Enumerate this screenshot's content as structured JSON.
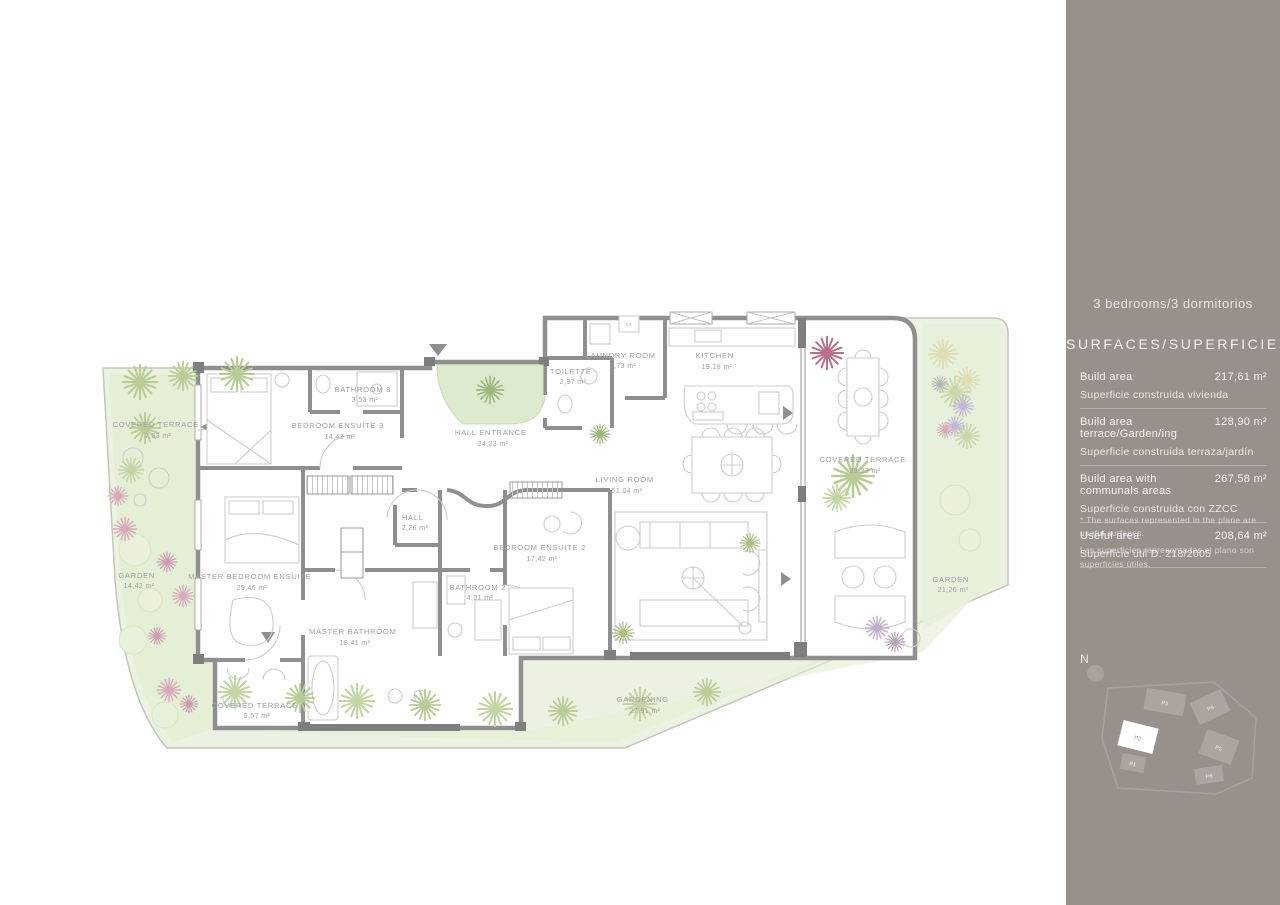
{
  "sidebar": {
    "bg_color": "#98908b",
    "title": "3 bedrooms/3 dormitorios",
    "subtitle": "SURFACES/SUPERFICIES",
    "rows": [
      {
        "en": "Build area",
        "value": "217,61 m²",
        "es": "Superficie construida vivienda"
      },
      {
        "en": "Build area terrace/Garden/ing",
        "value": "128,90 m²",
        "es": "Superficie construida terraza/jardín"
      },
      {
        "en": "Build area with communals areas",
        "value": "267,58 m²",
        "es": "Superficie construida con ZZCC"
      },
      {
        "en": "Useful area",
        "value": "208,64 m²",
        "es": "Superficie útil  D. 218/2005"
      }
    ],
    "footnote_en": "* The surfaces represented in the plane are useful surfaces.",
    "footnote_es": "Las superficies representadas el plano son superficies útiles.",
    "compass": "N",
    "siteplan": [
      "P3",
      "P4",
      "P5",
      "P6",
      "P2",
      "P1"
    ]
  },
  "plan": {
    "accent_wall_color": "#8f8f8f",
    "garden_color": "#ecf2e1",
    "laundry_unit": "LY",
    "rooms": [
      {
        "name": "COVERED TERRACE",
        "area": "7,53 m²"
      },
      {
        "name": "BEDROOM ENSUITE 3",
        "area": "14,43 m²"
      },
      {
        "name": "BATHROOM 3",
        "area": "3,53 m²"
      },
      {
        "name": "HALL ENTRANCE",
        "area": "24,23 m²"
      },
      {
        "name": "TOILETTE",
        "area": "2,97 m²"
      },
      {
        "name": "LAUNDRY ROOM",
        "area": "2,73 m²"
      },
      {
        "name": "KITCHEN",
        "area": "19,18 m²"
      },
      {
        "name": "LIVING ROOM",
        "area": "51,04 m²"
      },
      {
        "name": "COVERED TERRACE",
        "area": "39,23 m²"
      },
      {
        "name": "GARDEN",
        "area": "21,26 m²"
      },
      {
        "name": "GARDEN",
        "area": "14,42 m²"
      },
      {
        "name": "MASTER BEDROOM ENSUITE",
        "area": "29,46 m²"
      },
      {
        "name": "HALL",
        "area": "2,26 m²"
      },
      {
        "name": "BEDROOM ENSUITE 2",
        "area": "17,42 m²"
      },
      {
        "name": "BATHROOM 2",
        "area": "4,01 m²"
      },
      {
        "name": "MASTER BATHROOM",
        "area": "18,41 m²"
      },
      {
        "name": "COVERED TERRACE",
        "area": "5,57 m²"
      },
      {
        "name": "GARDENING",
        "area": "27,91 m²"
      }
    ]
  }
}
